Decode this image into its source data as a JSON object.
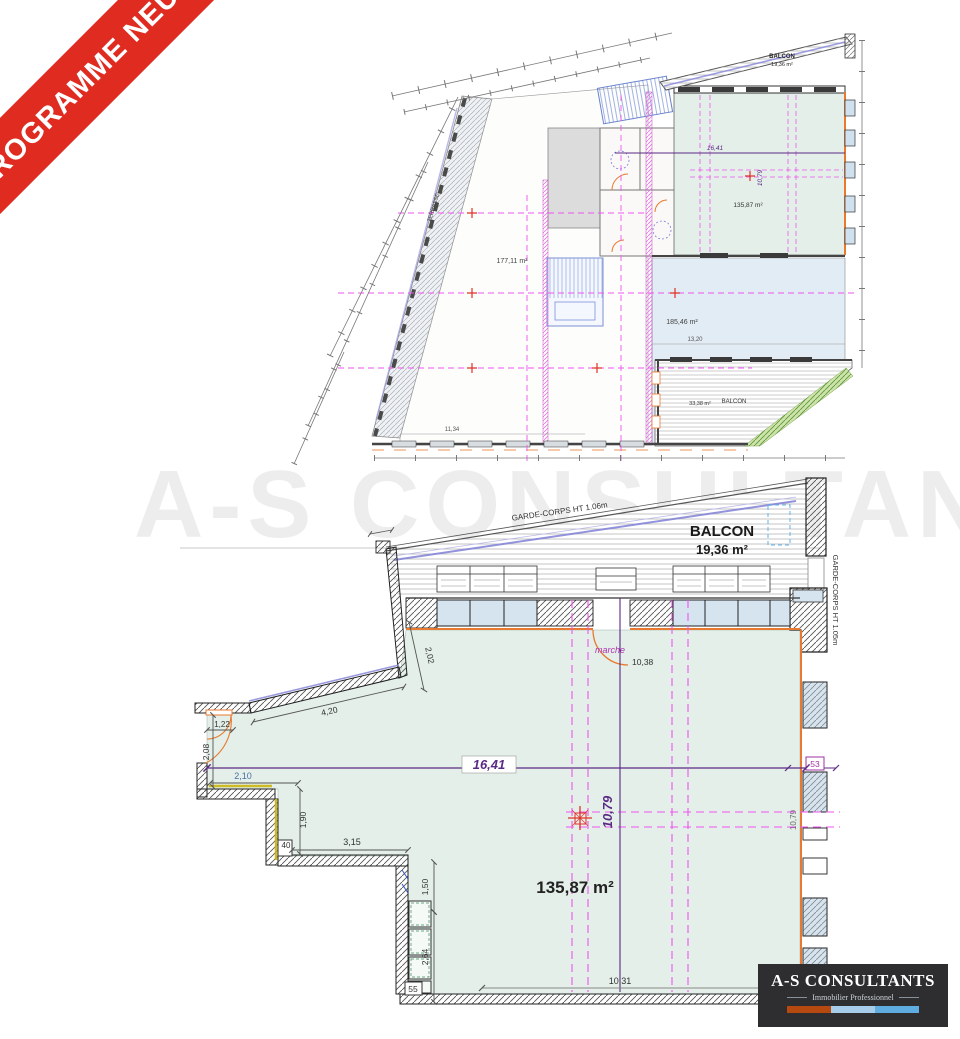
{
  "ribbon": {
    "label": "PROGRAMME NEUF"
  },
  "watermark": {
    "text": "A-S CONSULTANTS"
  },
  "overview": {
    "terrace_label": "TERRASSE",
    "room_left_area": "177,11 m²",
    "room_right_area": "185,46 m²",
    "room_green_area": "135,87 m²",
    "green_dim_w": "16,41",
    "green_dim_h": "10,79",
    "dim_bottom": "11,34",
    "dim_right": "13,20",
    "balcony_top": {
      "label": "BALCON",
      "area": "19,36 m²"
    },
    "balcony_corner": {
      "label": "BALCON",
      "area": "33,38 m²"
    }
  },
  "detail": {
    "balcony": {
      "label": "BALCON",
      "area": "19,36 m²",
      "guardrail_top": "GARDE-CORPS HT 1.06m",
      "guardrail_right": "GARDE-CORPS HT 1.05m"
    },
    "room": {
      "area": "135,87 m²",
      "width": "16,41",
      "depth": "10,79"
    },
    "door": {
      "label": "marche",
      "dim": "10,38"
    },
    "dims": {
      "d202": "2,02",
      "d420": "4,20",
      "d122": "1,22",
      "d208": "2,08",
      "d210": "2,10",
      "d190": "1,90",
      "d40": "40",
      "d315": "3,15",
      "d150": "1,50",
      "d264": "2,64",
      "d1031": "10,31"
    },
    "badges": {
      "b53": "53",
      "b55": "55"
    }
  },
  "logo": {
    "title": "A-S CONSULTANTS",
    "subtitle": "Immobilier Professionnel"
  },
  "colors": {
    "ribbon_red": "#df2b20",
    "room_green": "#e3efe8",
    "room_blue": "#e2ecf4",
    "grid_magenta": "#f055f0",
    "dim_purple": "#5b2a86",
    "wall_orange": "#e8792e",
    "guardrail_violet": "#8080d8",
    "marker_red": "#e0312a",
    "logo_bar": [
      "#b5490f",
      "#a6cce9",
      "#5fade0"
    ]
  }
}
